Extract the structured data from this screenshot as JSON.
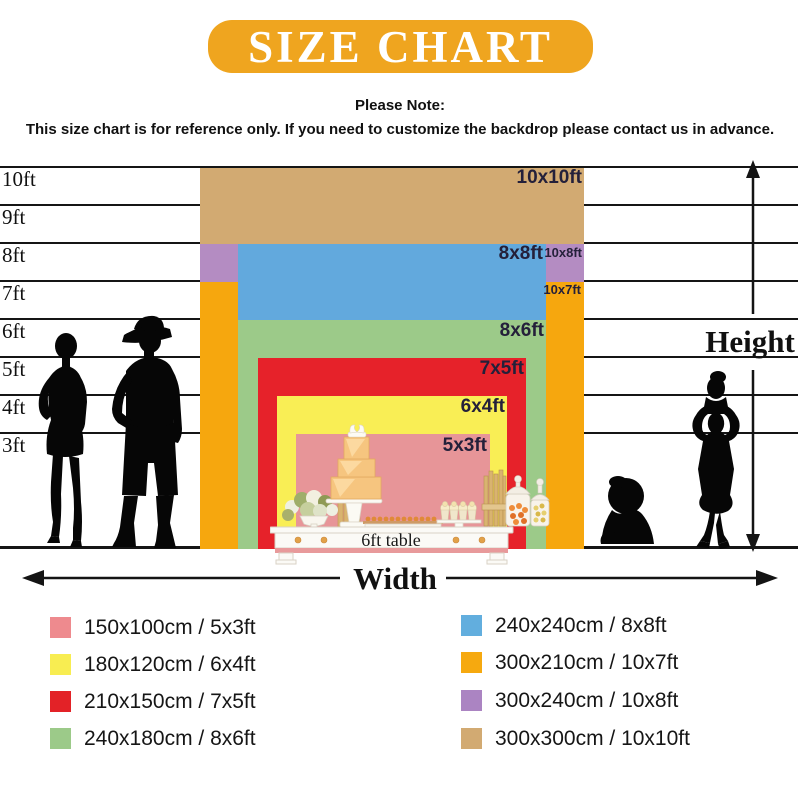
{
  "banner": {
    "title": "SIZE CHART",
    "bg": "#efa51f",
    "text_color": "#ffffff"
  },
  "note": {
    "heading": "Please Note:",
    "body": "This size chart is for reference only. If you need to customize the backdrop please contact us in advance."
  },
  "axes": {
    "height": "Height",
    "width": "Width"
  },
  "gridlines": [
    "10ft",
    "9ft",
    "8ft",
    "7ft",
    "6ft",
    "5ft",
    "4ft",
    "3ft"
  ],
  "rects": [
    {
      "label": "10x10ft",
      "color": "#d2aa72"
    },
    {
      "label": "10x8ft",
      "color": "#b48cc2"
    },
    {
      "label": "10x7ft",
      "color": "#f6a70e"
    },
    {
      "label": "8x8ft",
      "color": "#62a9dd"
    },
    {
      "label": "8x6ft",
      "color": "#9cca89"
    },
    {
      "label": "7x5ft",
      "color": "#e6222a"
    },
    {
      "label": "6x4ft",
      "color": "#f9ee55"
    },
    {
      "label": "5x3ft",
      "color": "#e79598"
    }
  ],
  "table_label": "6ft table",
  "legend": {
    "left": [
      {
        "color": "#ee8a8e",
        "label": "150x100cm / 5x3ft"
      },
      {
        "color": "#f8ed51",
        "label": "180x120cm / 6x4ft"
      },
      {
        "color": "#e32227",
        "label": "210x150cm / 7x5ft"
      },
      {
        "color": "#9cca89",
        "label": "240x180cm / 8x6ft"
      }
    ],
    "right": [
      {
        "color": "#62aede",
        "label": "240x240cm / 8x8ft"
      },
      {
        "color": "#f6a90f",
        "label": "300x210cm / 10x7ft"
      },
      {
        "color": "#ab84c2",
        "label": "300x240cm / 10x8ft"
      },
      {
        "color": "#d2aa72",
        "label": "300x300cm / 10x10ft"
      }
    ]
  },
  "chart_data": {
    "type": "table",
    "title": "SIZE CHART",
    "subtitle": "Please Note: This size chart is for reference only. If you need to customize the backdrop please contact us in advance.",
    "xlabel": "Width",
    "ylabel": "Height",
    "y_ticks_ft": [
      3,
      4,
      5,
      6,
      7,
      8,
      9,
      10
    ],
    "sizes": [
      {
        "cm": "150x100cm",
        "ft": "5x3ft",
        "width_ft": 5,
        "height_ft": 3,
        "color": "#ee8a8e"
      },
      {
        "cm": "180x120cm",
        "ft": "6x4ft",
        "width_ft": 6,
        "height_ft": 4,
        "color": "#f8ed51"
      },
      {
        "cm": "210x150cm",
        "ft": "7x5ft",
        "width_ft": 7,
        "height_ft": 5,
        "color": "#e32227"
      },
      {
        "cm": "240x180cm",
        "ft": "8x6ft",
        "width_ft": 8,
        "height_ft": 6,
        "color": "#9cca89"
      },
      {
        "cm": "240x240cm",
        "ft": "8x8ft",
        "width_ft": 8,
        "height_ft": 8,
        "color": "#62aede"
      },
      {
        "cm": "300x210cm",
        "ft": "10x7ft",
        "width_ft": 10,
        "height_ft": 7,
        "color": "#f6a90f"
      },
      {
        "cm": "300x240cm",
        "ft": "10x8ft",
        "width_ft": 10,
        "height_ft": 8,
        "color": "#ab84c2"
      },
      {
        "cm": "300x300cm",
        "ft": "10x10ft",
        "width_ft": 10,
        "height_ft": 10,
        "color": "#d2aa72"
      }
    ],
    "annotations": [
      "6ft table"
    ],
    "legend_position": "bottom"
  }
}
